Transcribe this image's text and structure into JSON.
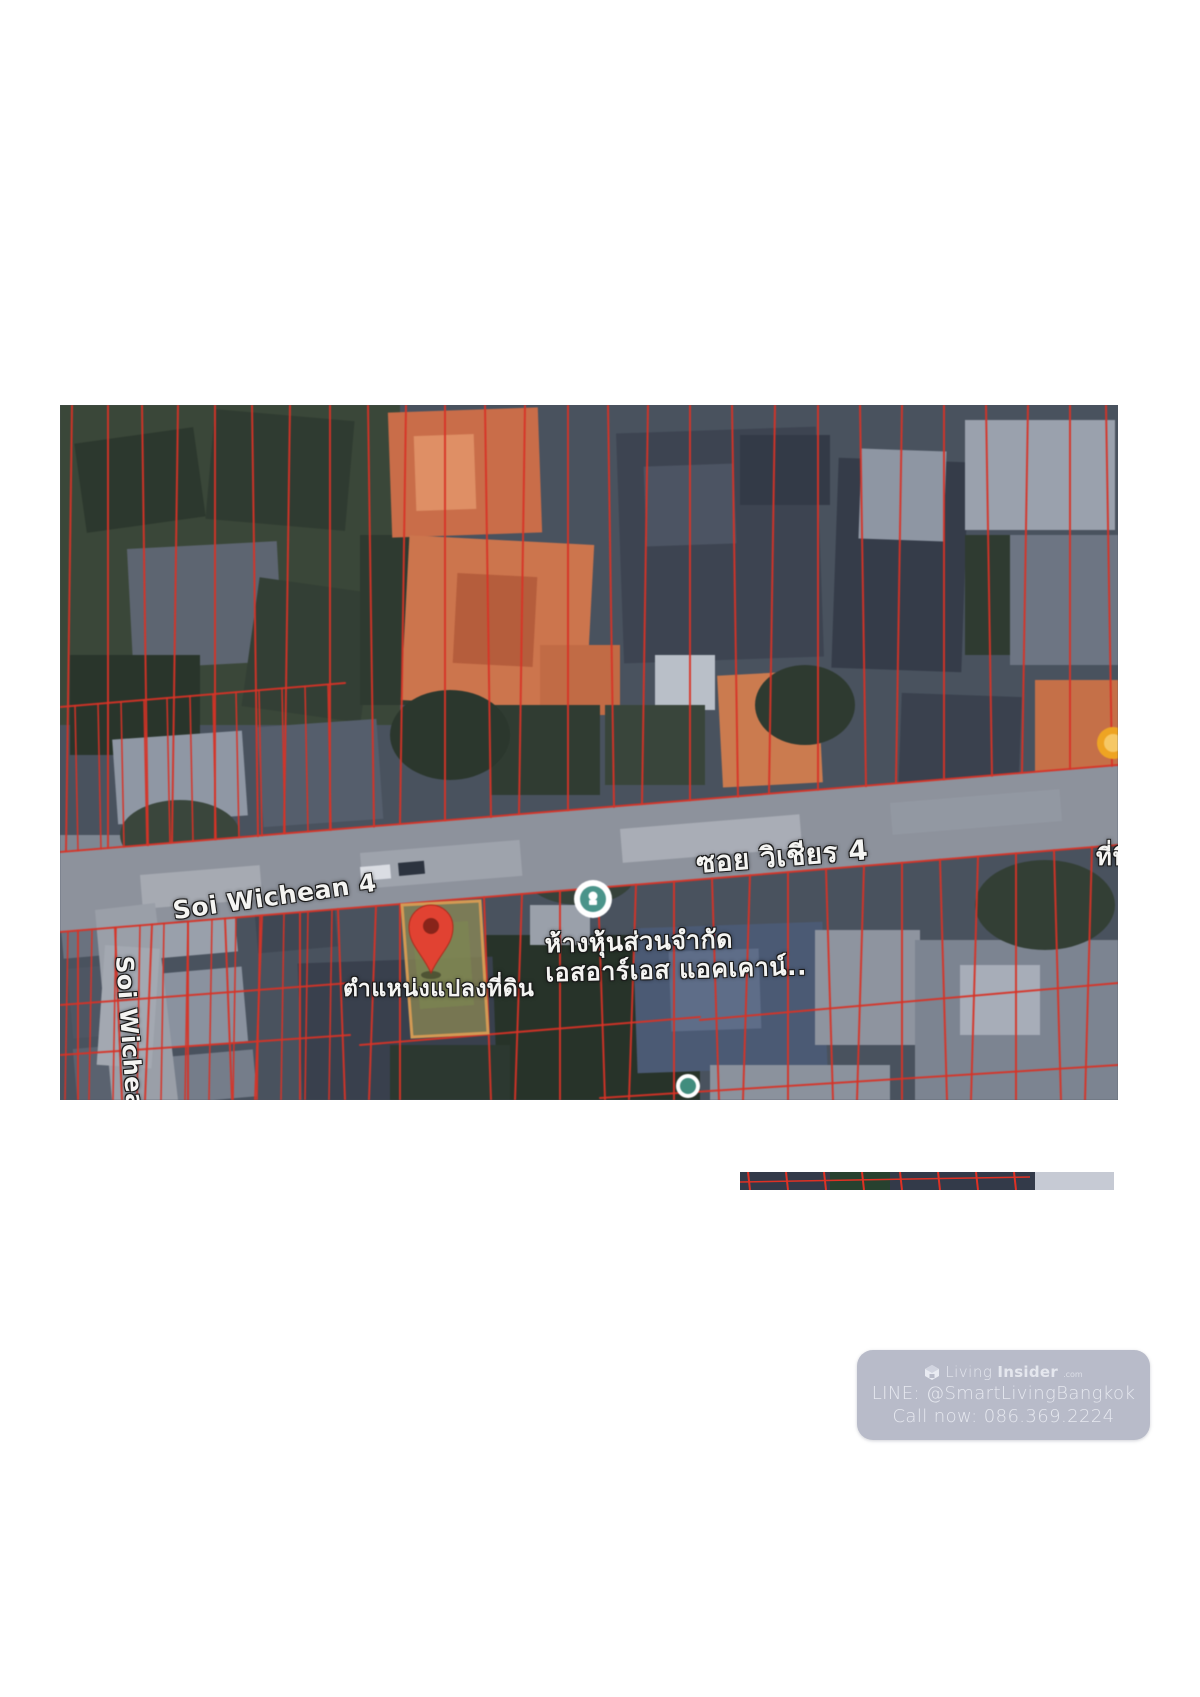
{
  "map": {
    "labels": {
      "street_thai": "ซอย วิเชียร 4",
      "street_english": "Soi Wichean 4",
      "side_street": "Soi Wichean 3/2",
      "pin_caption": "ตำแหน่งแปลงที่ดิน",
      "business_line1": "ห้างหุ้นส่วนจำกัด",
      "business_line2": "เอสอาร์เอส แอคเคาน์..",
      "right_edge_partial": "ที่นี่"
    },
    "colors": {
      "parcel_line": "#df3124",
      "highlight_fill": "#8f8a52",
      "highlight_border": "#d69a50",
      "pin": "#e8402f",
      "poi_teal": "#47958a",
      "poi_orange": "#f2a41c",
      "road": "#8d929d"
    }
  },
  "watermark": {
    "background": "#b8bbc9",
    "brand": {
      "prefix": "Living",
      "suffix": "Insider",
      "tld": ".com"
    },
    "line_contact": "LINE: @SmartLivingBangkok",
    "phone_contact": "Call now: 086.369.2224"
  }
}
